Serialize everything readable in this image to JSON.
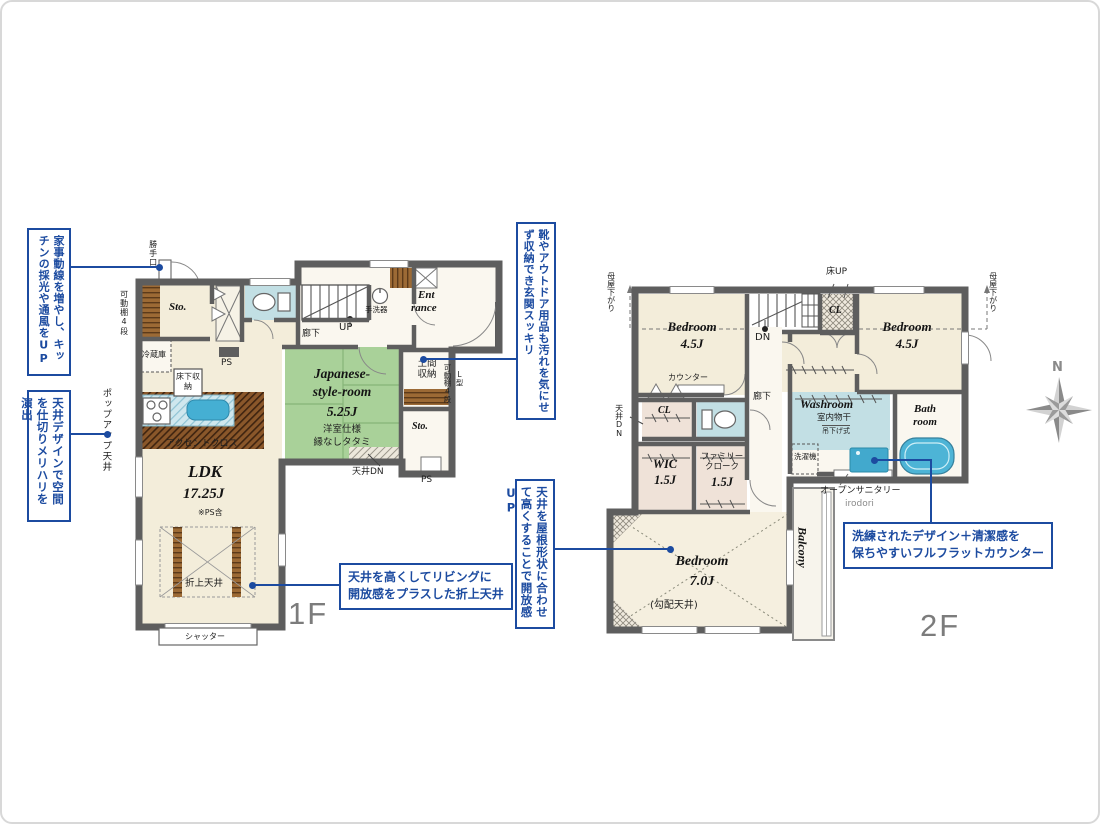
{
  "notes": {
    "kitchen_flow": "家事動線を増やし、キッチンの採光や通風をUP",
    "ceiling_design": "天井デザインで空間を仕切りメリハリを演出",
    "coffered_l1": "天井を高くしてリビングに",
    "coffered_l2": "開放感をプラスした折上天井",
    "entrance_storage": "靴やアウトドア用品も汚れを気にせず収納でき玄関スッキリ",
    "sloped_ceiling": "天井を屋根形状に合わせて高くすることで開放感UP",
    "counter_l1": "洗練されたデザイン＋清潔感を",
    "counter_l2": "保ちやすいフルフラットカウンター"
  },
  "floor1": {
    "floor_label": "1F",
    "labels": {
      "katteguchi": "勝手口",
      "kadou_dana": "可動棚4段",
      "sto1": "Sto.",
      "reizouko": "冷蔵庫",
      "yukashita": "床下収納",
      "ps_kitchen": "PS",
      "popup": "ポップアップ天井",
      "accent": "アクセントクロス",
      "ldk": "LDK",
      "ldk_size": "17.25J",
      "ps_note": "※PS含",
      "oriage": "折上天井",
      "shutter": "シャッター",
      "rouka": "廊下",
      "up": "UP",
      "tearai": "手洗器",
      "ent_l1": "Ent",
      "ent_l2": "rance",
      "doma": "土間\n収納",
      "kadou_dana_r": "可動棚4段",
      "l_gata": "L型",
      "sto2": "Sto.",
      "ps_bottom": "PS",
      "tenjo_dn": "天井DN",
      "jp_l1": "Japanese-",
      "jp_l2": "style-room",
      "jp_size": "5.25J",
      "jp_spec1": "洋室仕様",
      "jp_spec2": "縁なしタタミ"
    }
  },
  "floor2": {
    "floor_label": "2F",
    "labels": {
      "moya_left": "母屋下がり",
      "moya_right": "母屋下がり",
      "yuka_up": "床UP",
      "bed_left": "Bedroom",
      "bed_left_size": "4.5J",
      "counter": "カウンター",
      "cl_top": "CL",
      "bed_right": "Bedroom",
      "bed_right_size": "4.5J",
      "dn": "DN",
      "rouka": "廊下",
      "cl_left": "CL",
      "tenjo_dn": "天井DN",
      "wic": "WIC",
      "wic_size": "1.5J",
      "family_cloak": "ファミリー\nクローク",
      "family_size": "1.5J",
      "washroom": "Washroom",
      "monohoshi": "室内物干",
      "tsurisage": "吊下げ式",
      "sentakuki": "洗濯機",
      "bath": "Bath\nroom",
      "open_sanitary": "オープンサニタリー",
      "irodori": "irodori",
      "bed7": "Bedroom",
      "bed7_size": "7.0J",
      "koubai": "(勾配天井)",
      "balcony": "Balcony"
    }
  },
  "compass": {
    "north": "N"
  }
}
